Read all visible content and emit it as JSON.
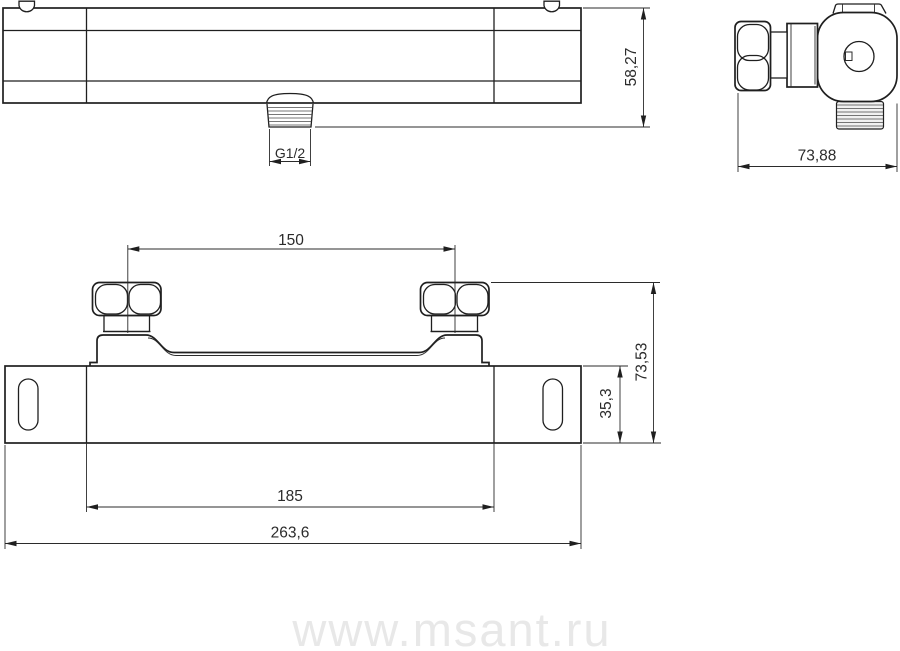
{
  "drawing": {
    "dimensions": {
      "front_height": "58,27",
      "outlet_thread": "G1/2",
      "side_depth": "73,88",
      "inlet_spacing": "150",
      "overall_height": "73,53",
      "body_height": "35,3",
      "inner_width": "185",
      "overall_width": "263,6"
    },
    "watermark": "www.msant.ru",
    "colors": {
      "line": "#1f1f1f",
      "dim_text": "#2b2b2b",
      "watermark": "#e8e8e8",
      "background": "#ffffff"
    }
  }
}
